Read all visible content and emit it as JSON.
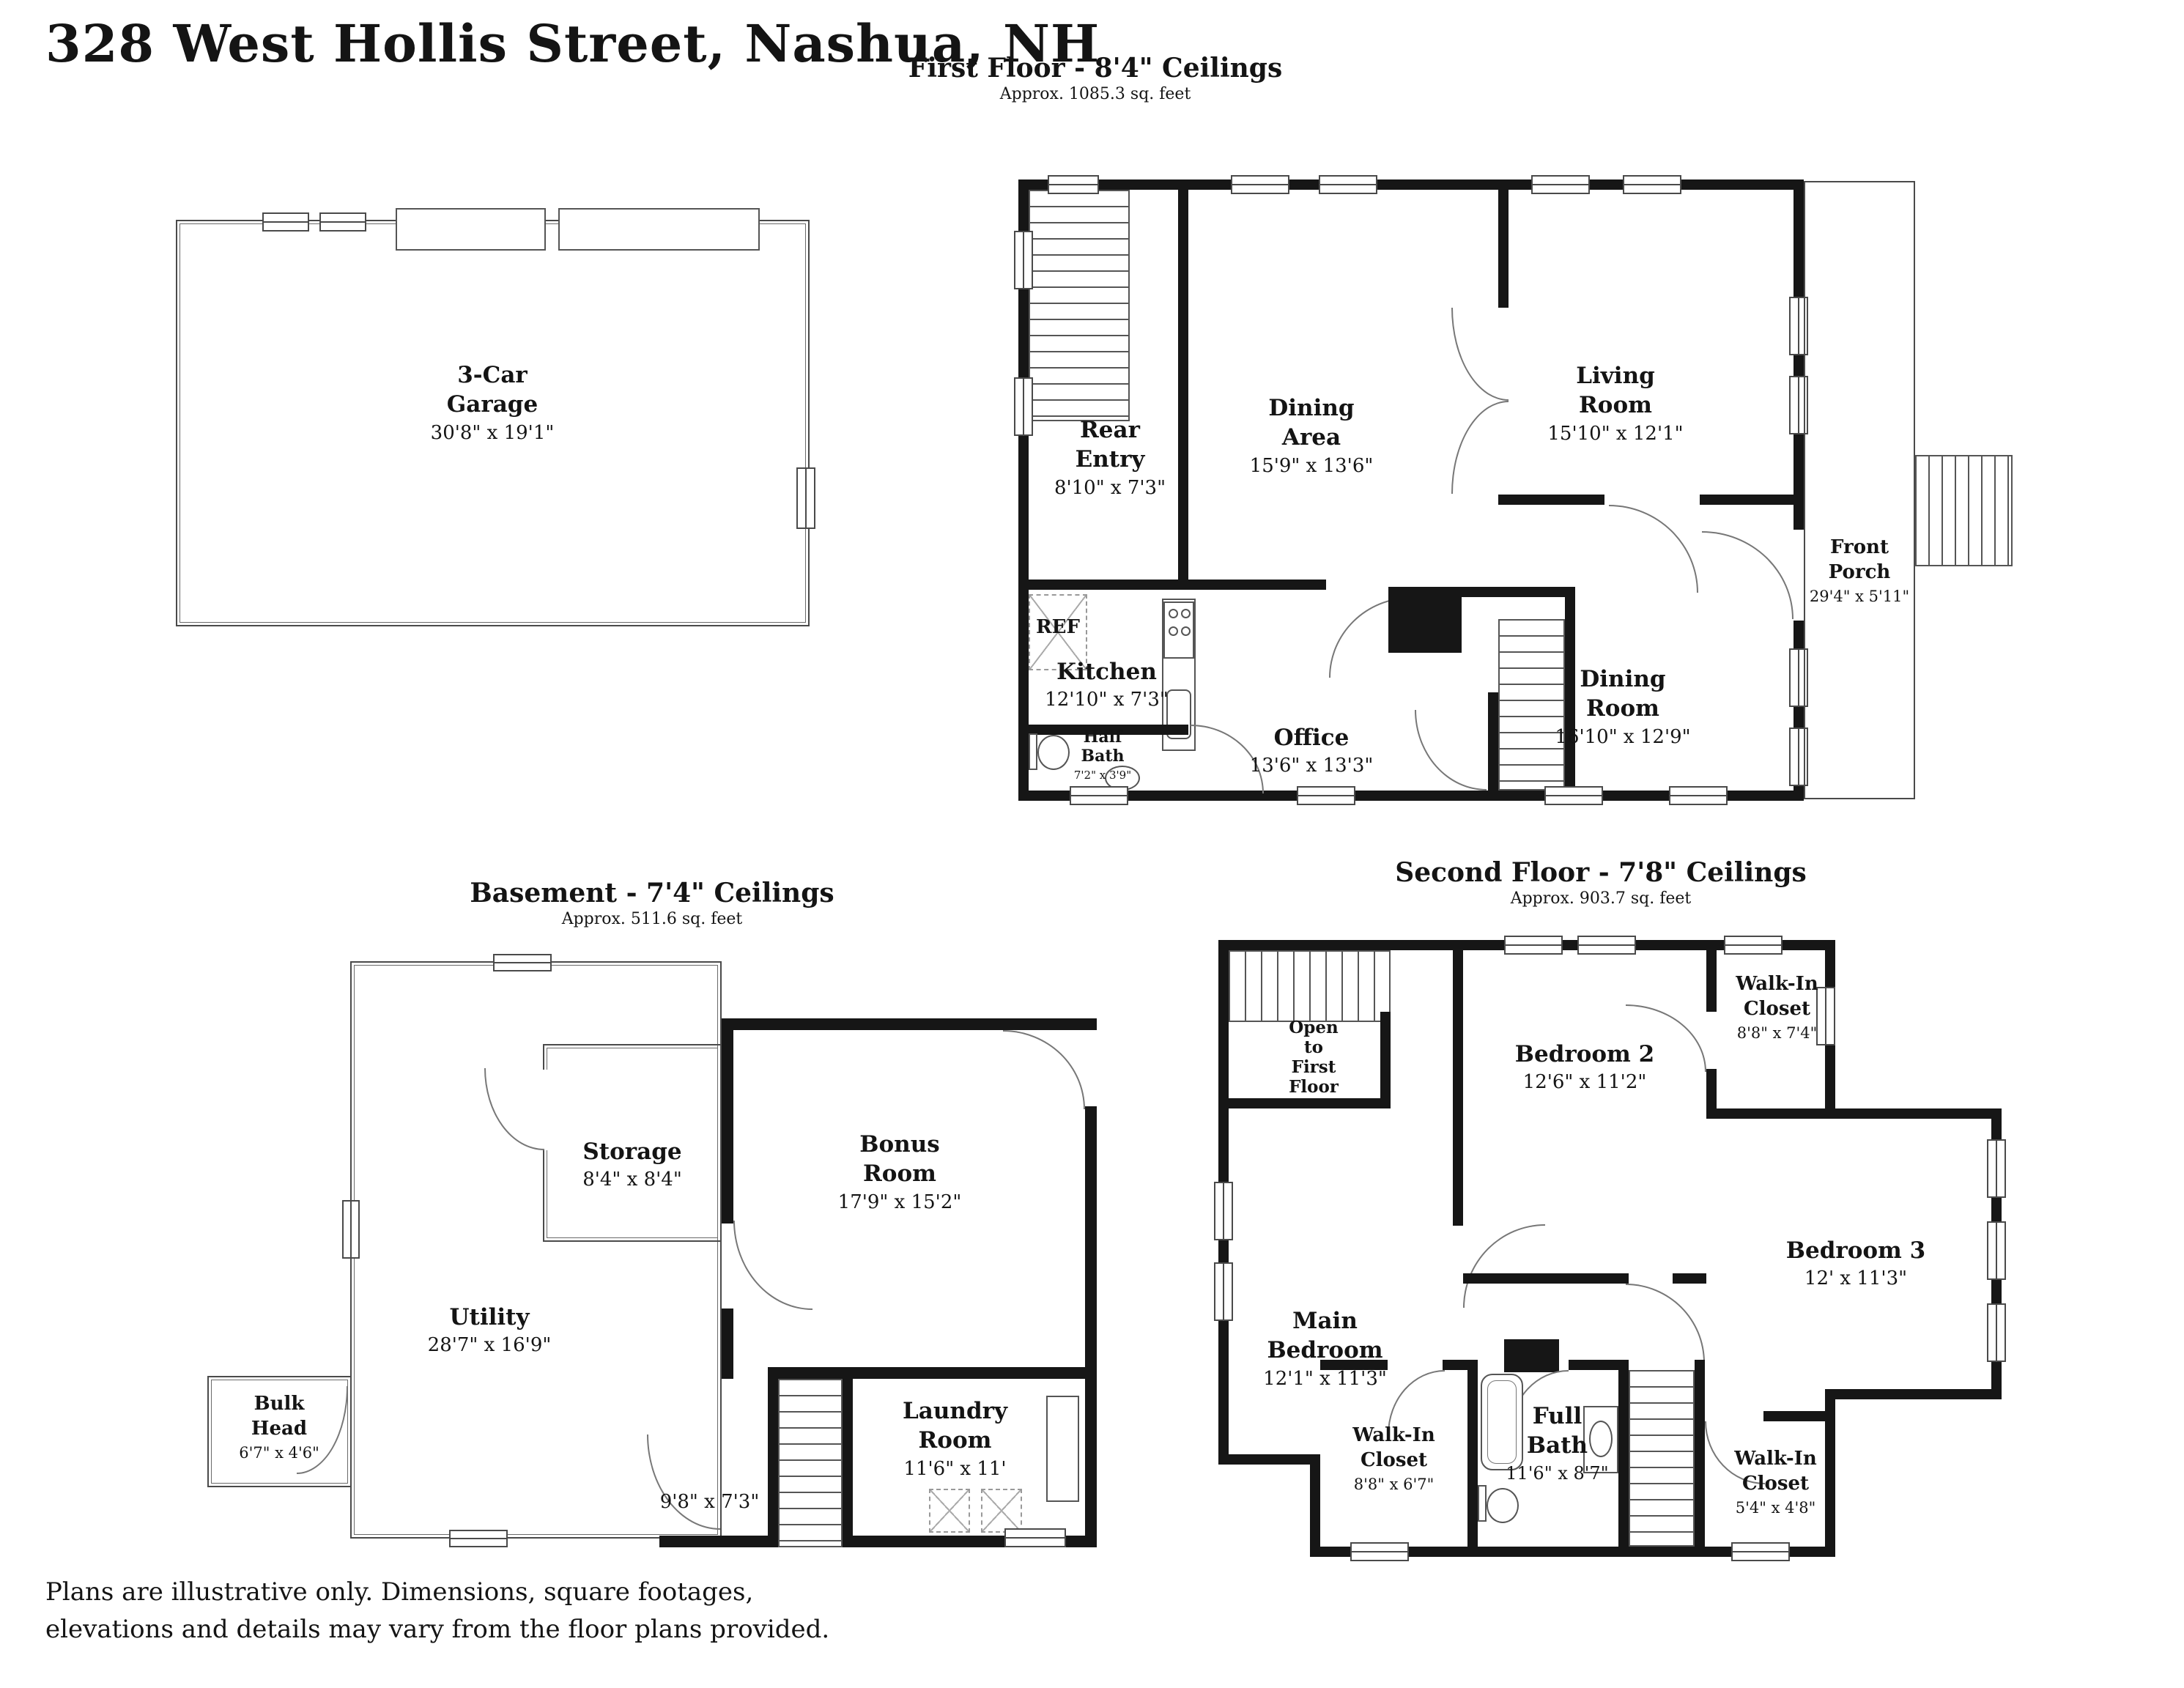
{
  "title": "328 West Hollis Street, Nashua, NH",
  "footer": {
    "line1": "Plans are illustrative only. Dimensions, square footages,",
    "line2": "elevations and details may vary from the floor plans provided."
  },
  "garage": {
    "rooms": [
      {
        "name": "3-Car\nGarage",
        "dims": "30'8\" x 19'1\""
      }
    ]
  },
  "first_floor": {
    "heading": "First Floor - 8'4\" Ceilings",
    "subheading": "Approx. 1085.3 sq. feet",
    "rooms": [
      {
        "name": "Rear\nEntry",
        "dims": "8'10\" x 7'3\""
      },
      {
        "name": "Dining\nArea",
        "dims": "15'9\" x 13'6\""
      },
      {
        "name": "Living\nRoom",
        "dims": "15'10\" x 12'1\""
      },
      {
        "name": "Kitchen",
        "dims": "12'10\" x 7'3\""
      },
      {
        "name": "Office",
        "dims": "13'6\" x 13'3\""
      },
      {
        "name": "Half\nBath",
        "dims": "7'2\" x 3'9\""
      },
      {
        "name": "Dining\nRoom",
        "dims": "16'10\" x 12'9\""
      },
      {
        "name": "Front\nPorch",
        "dims": "29'4\" x 5'11\""
      }
    ],
    "annotations": {
      "fridge": "REF"
    }
  },
  "basement": {
    "heading": "Basement - 7'4\" Ceilings",
    "subheading": "Approx. 511.6 sq. feet",
    "rooms": [
      {
        "name": "Storage",
        "dims": "8'4\" x 8'4\""
      },
      {
        "name": "Bonus\nRoom",
        "dims": "17'9\" x 15'2\""
      },
      {
        "name": "Utility",
        "dims": "28'7\" x 16'9\""
      },
      {
        "name": "Bulk\nHead",
        "dims": "6'7\" x 4'6\""
      },
      {
        "name": "Laundry\nRoom",
        "dims": "11'6\" x 11'"
      }
    ],
    "annotations": {
      "passage_dims": "9'8\" x 7'3\""
    }
  },
  "second_floor": {
    "heading": "Second Floor - 7'8\" Ceilings",
    "subheading": "Approx. 903.7 sq. feet",
    "rooms": [
      {
        "name": "Open\nto\nFirst\nFloor",
        "dims": ""
      },
      {
        "name": "Bedroom 2",
        "dims": "12'6\" x 11'2\""
      },
      {
        "name": "Walk-In\nCloset",
        "dims": "8'8\" x 7'4\""
      },
      {
        "name": "Main\nBedroom",
        "dims": "12'1\" x 11'3\""
      },
      {
        "name": "Bedroom 3",
        "dims": "12' x 11'3\""
      },
      {
        "name": "Walk-In\nCloset",
        "dims": "8'8\" x 6'7\""
      },
      {
        "name": "Full\nBath",
        "dims": "11'6\" x 8'7\""
      },
      {
        "name": "Walk-In\nCloset",
        "dims": "5'4\" x 4'8\""
      }
    ]
  }
}
